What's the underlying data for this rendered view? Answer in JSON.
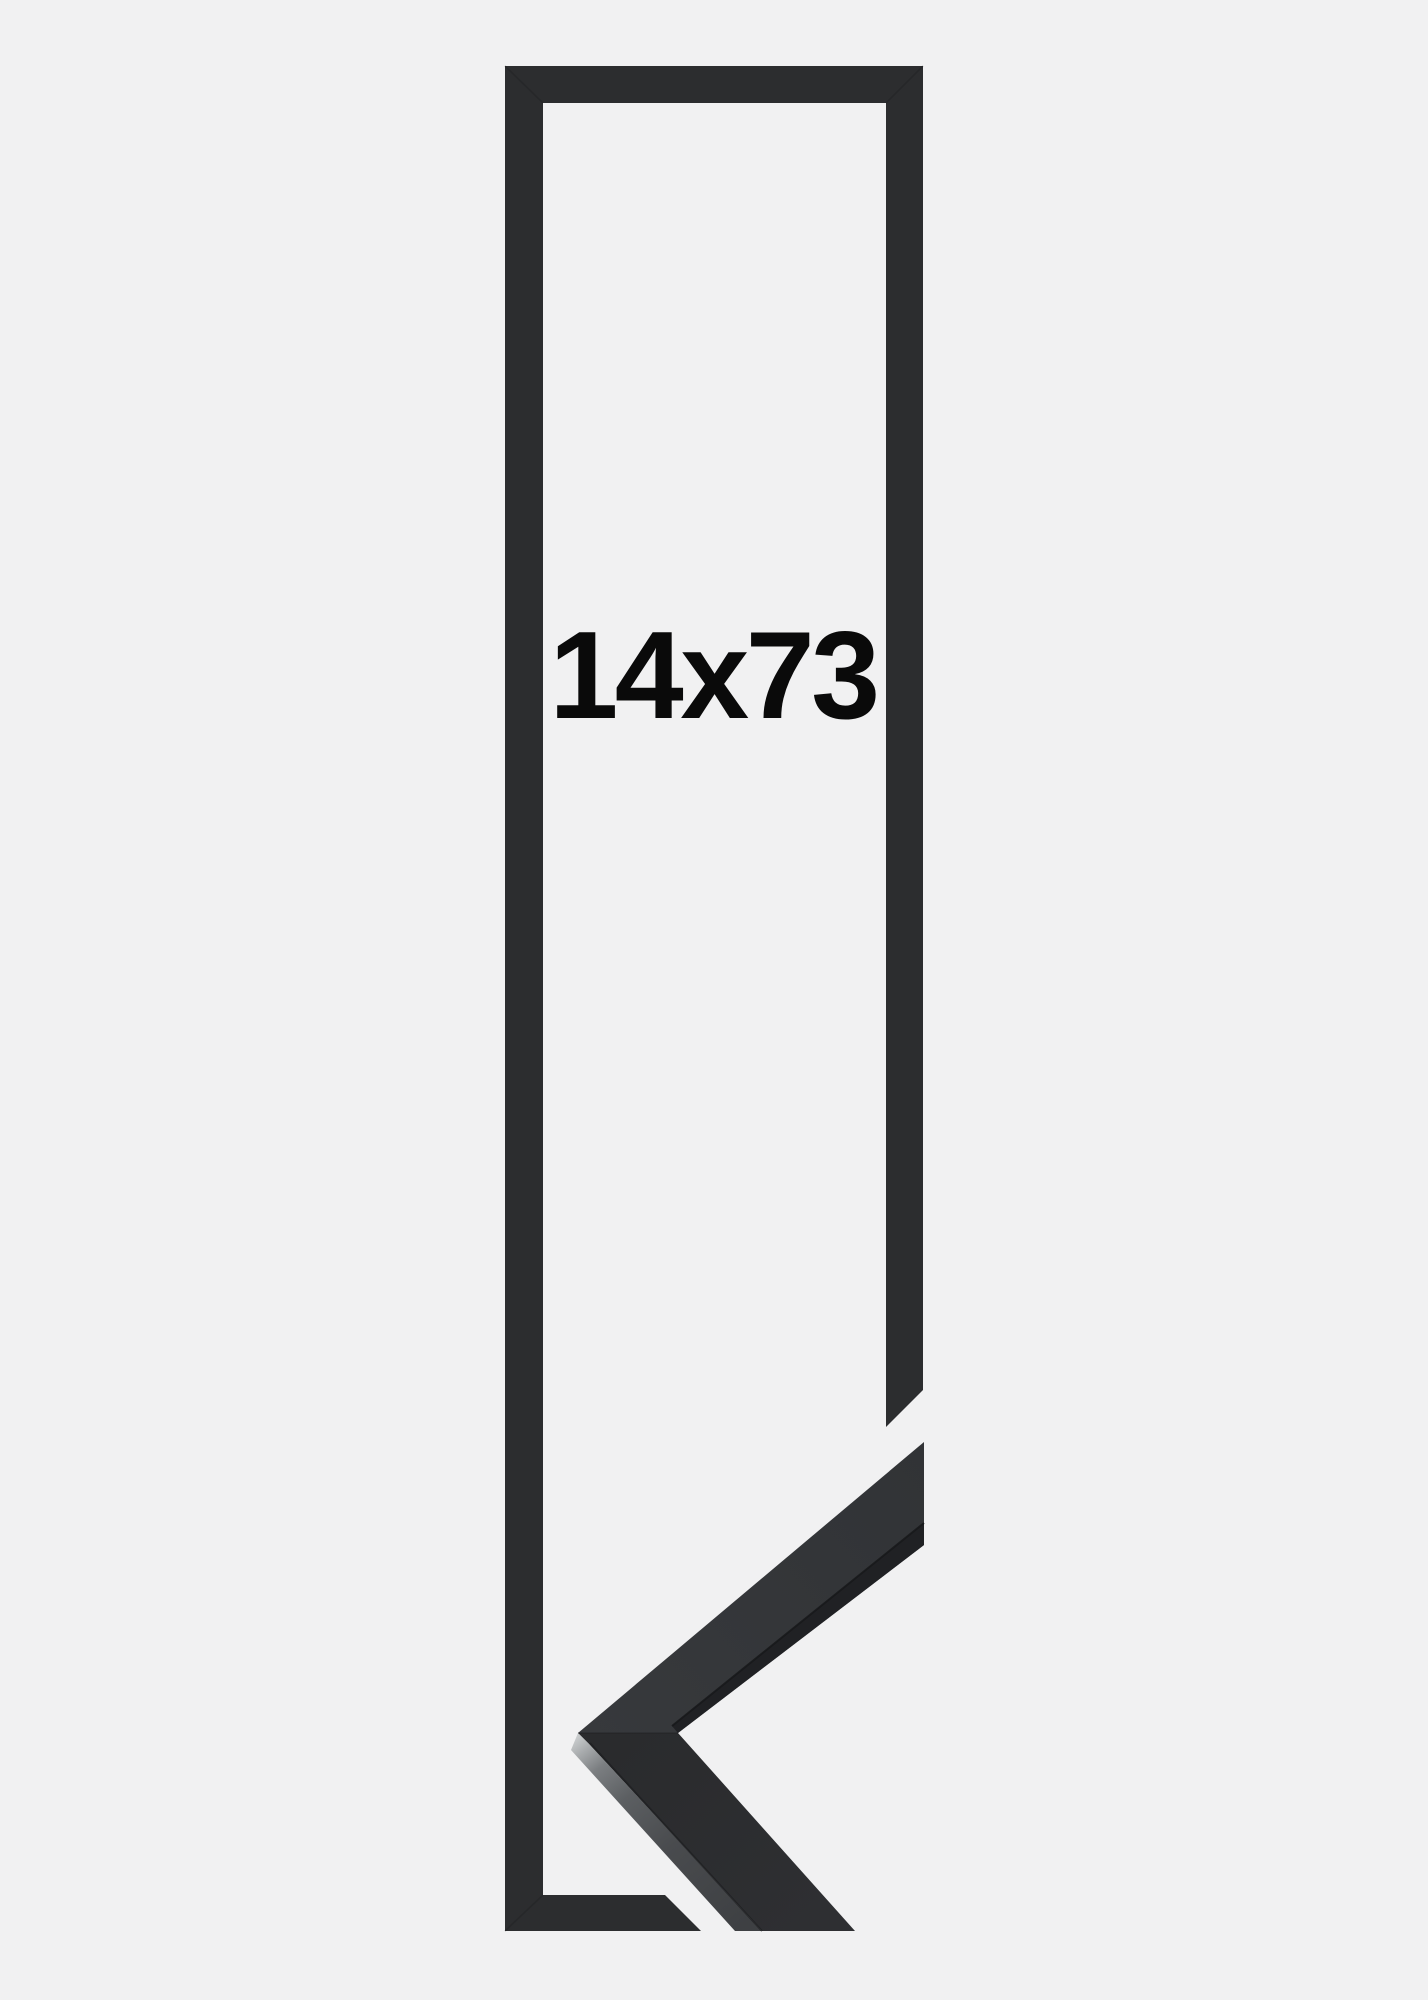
{
  "product": {
    "size_label": "14x73"
  },
  "colors": {
    "background": "#f1f1f2",
    "frame": "#2c2d2f",
    "label": "#0a0a0a",
    "corner_front_sliver": "#202124",
    "corner_side_light": "#ced1d2",
    "corner_side_dark": "#3e4043",
    "seam": "#1a1b1d"
  }
}
